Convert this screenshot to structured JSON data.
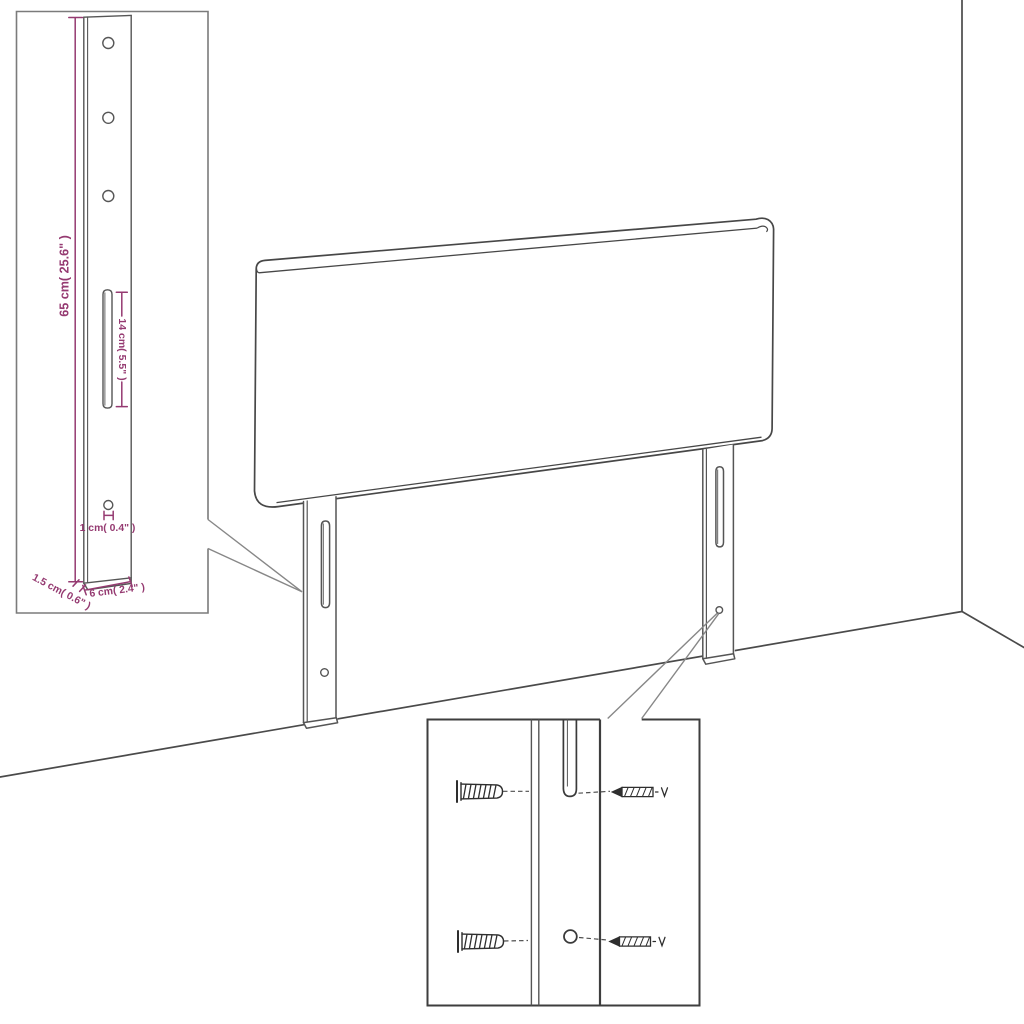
{
  "diagram": {
    "kind": "headboard wall-mount assembly diagram",
    "background": "#ffffff"
  },
  "colors": {
    "dimension": "#953a71",
    "outline": "#474747",
    "leg_outline": "#555555",
    "inset_border": "#7b7b7b",
    "detail_border": "#3e3e3e",
    "callout": "#878787",
    "hardware": "#2e2e2e",
    "room_line": "#4a4a4a"
  },
  "dimensions": {
    "leg_height": "65 cm( 25.6\" )",
    "slot_length": "14 cm( 5.5\" )",
    "hole_diameter": "1 cm( 0.4\" )",
    "leg_thickness": "1.5 cm( 0.6\" )",
    "leg_width": "6 cm( 2.4\" )"
  },
  "parts": {
    "headboard": "upholstered headboard panel",
    "mounting_leg": "slotted mounting leg",
    "wall_plug": "expansion wall plug",
    "screw": "mounting screw"
  }
}
